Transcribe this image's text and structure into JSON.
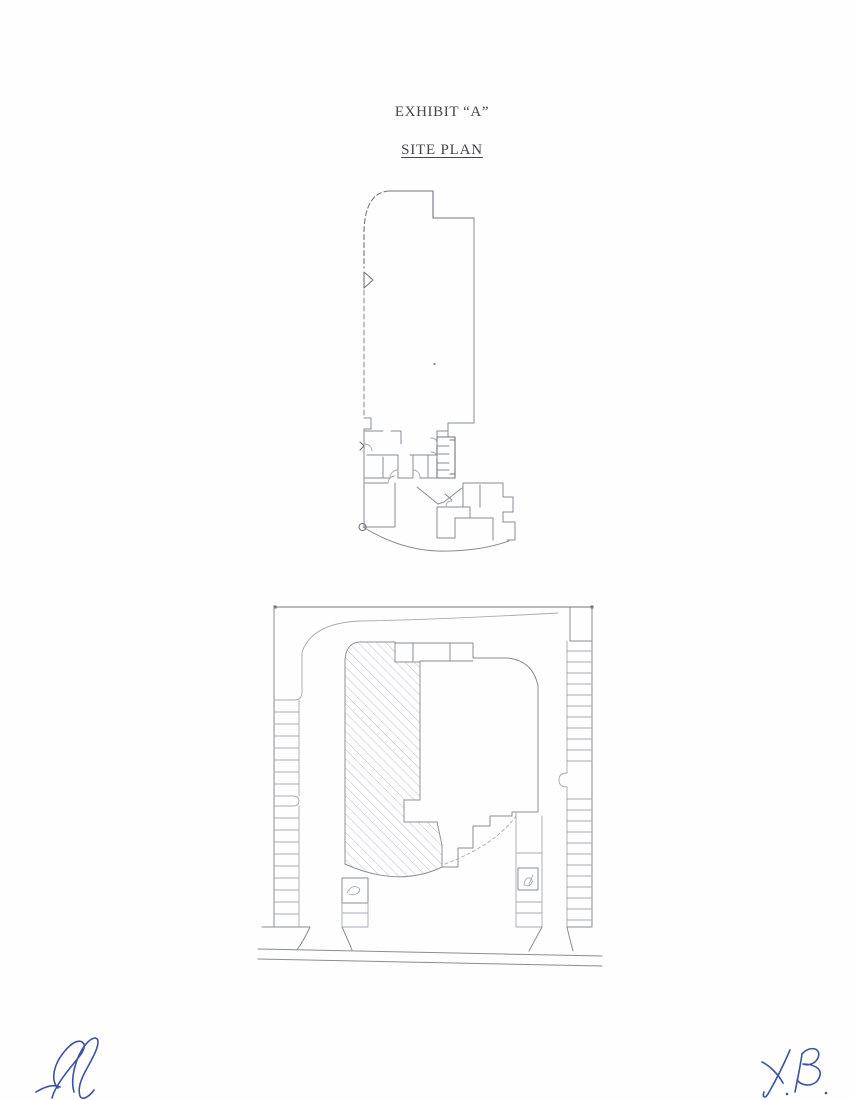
{
  "document": {
    "title": "EXHIBIT “A”",
    "subtitle": "SITE PLAN",
    "page_background": "#fefefe",
    "text_color": "#45464b"
  },
  "figures": {
    "floor_plan": {
      "name": "floor-plan-drawing",
      "description": "architectural floor plan of leased premises, rounded top-left corner, office rooms and restroom core at bottom, curved bottom wall",
      "line_color": "#878d96"
    },
    "site_plan": {
      "name": "site-plan-drawing",
      "description": "site plan with hatched demised premises inside building footprint, perimeter parking stalls, two driveway entrances and street at bottom",
      "line_color": "#878d96",
      "hatch_color": "#a9aeb6"
    }
  },
  "signatures": {
    "left": {
      "type": "handwritten-initials",
      "ink_color": "#3f51a5"
    },
    "right": {
      "type": "handwritten-initials",
      "ink_color": "#3f51a5"
    }
  }
}
